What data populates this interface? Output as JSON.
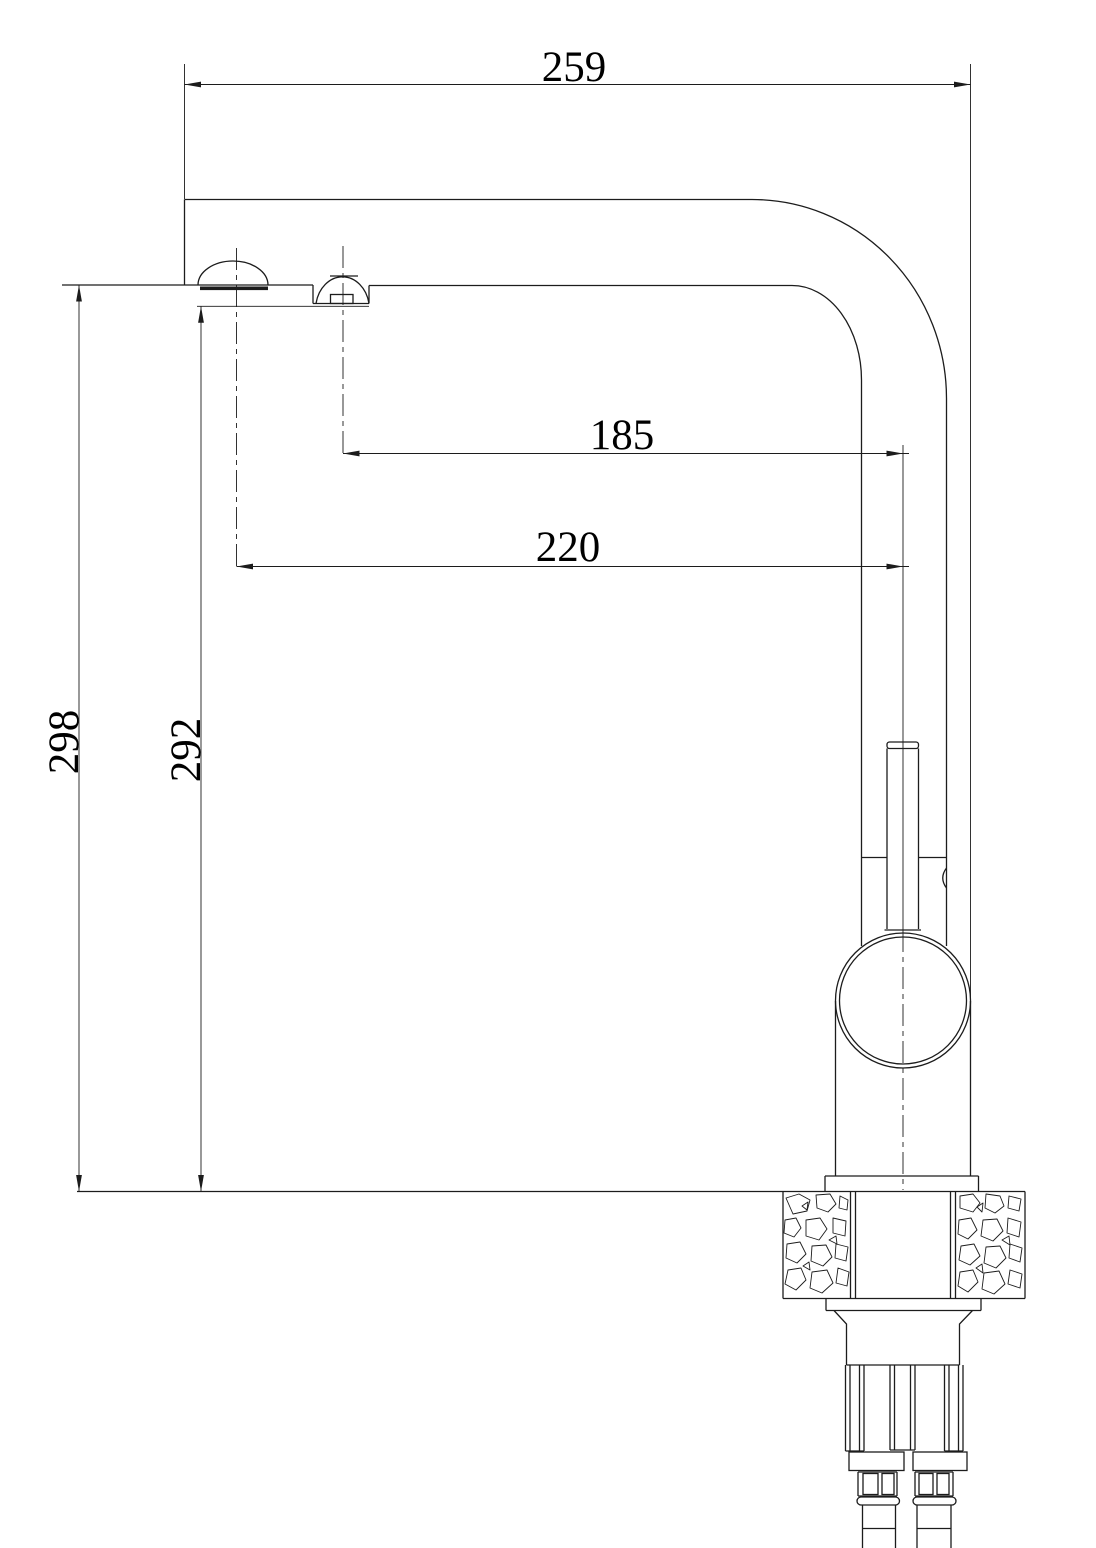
{
  "drawing": {
    "background": "#ffffff",
    "line_color": "#1c1c1c",
    "labels": {
      "overall_width": "259",
      "reach_secondary": "185",
      "reach_main": "220",
      "overall_height": "298",
      "height_secondary": "292"
    }
  }
}
